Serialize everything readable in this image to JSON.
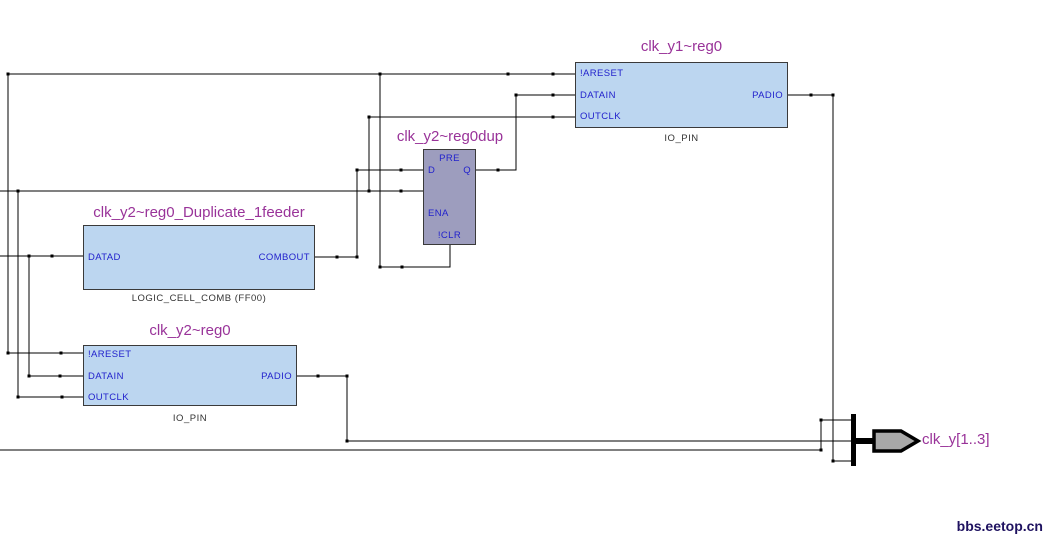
{
  "colors": {
    "background": "#FFFFFF",
    "io_block_fill": "#BCD6F0",
    "dff_block_fill": "#9D9DBE",
    "block_border": "#3A3A3A",
    "port_text": "#2222CC",
    "title_text": "#993399",
    "type_label_text": "#333333",
    "wire": "#000000",
    "pin_symbol_fill": "#A8A8A8",
    "watermark_text": "#1F1260"
  },
  "blocks": {
    "clk_y1_reg0": {
      "title": "clk_y1~reg0",
      "type_label": "IO_PIN",
      "ports": {
        "in1": "!ARESET",
        "in2": "DATAIN",
        "in3": "OUTCLK",
        "out1": "PADIO"
      }
    },
    "clk_y2_reg0dup": {
      "title": "clk_y2~reg0dup",
      "ports": {
        "pre": "PRE",
        "d": "D",
        "q": "Q",
        "ena": "ENA",
        "clr": "!CLR"
      }
    },
    "clk_y2_reg0_feeder": {
      "title": "clk_y2~reg0_Duplicate_1feeder",
      "type_label": "LOGIC_CELL_COMB (FF00)",
      "ports": {
        "in1": "DATAD",
        "out1": "COMBOUT"
      }
    },
    "clk_y2_reg0": {
      "title": "clk_y2~reg0",
      "type_label": "IO_PIN",
      "ports": {
        "in1": "!ARESET",
        "in2": "DATAIN",
        "in3": "OUTCLK",
        "out1": "PADIO"
      }
    }
  },
  "output_pin": {
    "label": "clk_y[1..3]"
  },
  "watermark": {
    "text": "bbs.eetop.cn"
  }
}
